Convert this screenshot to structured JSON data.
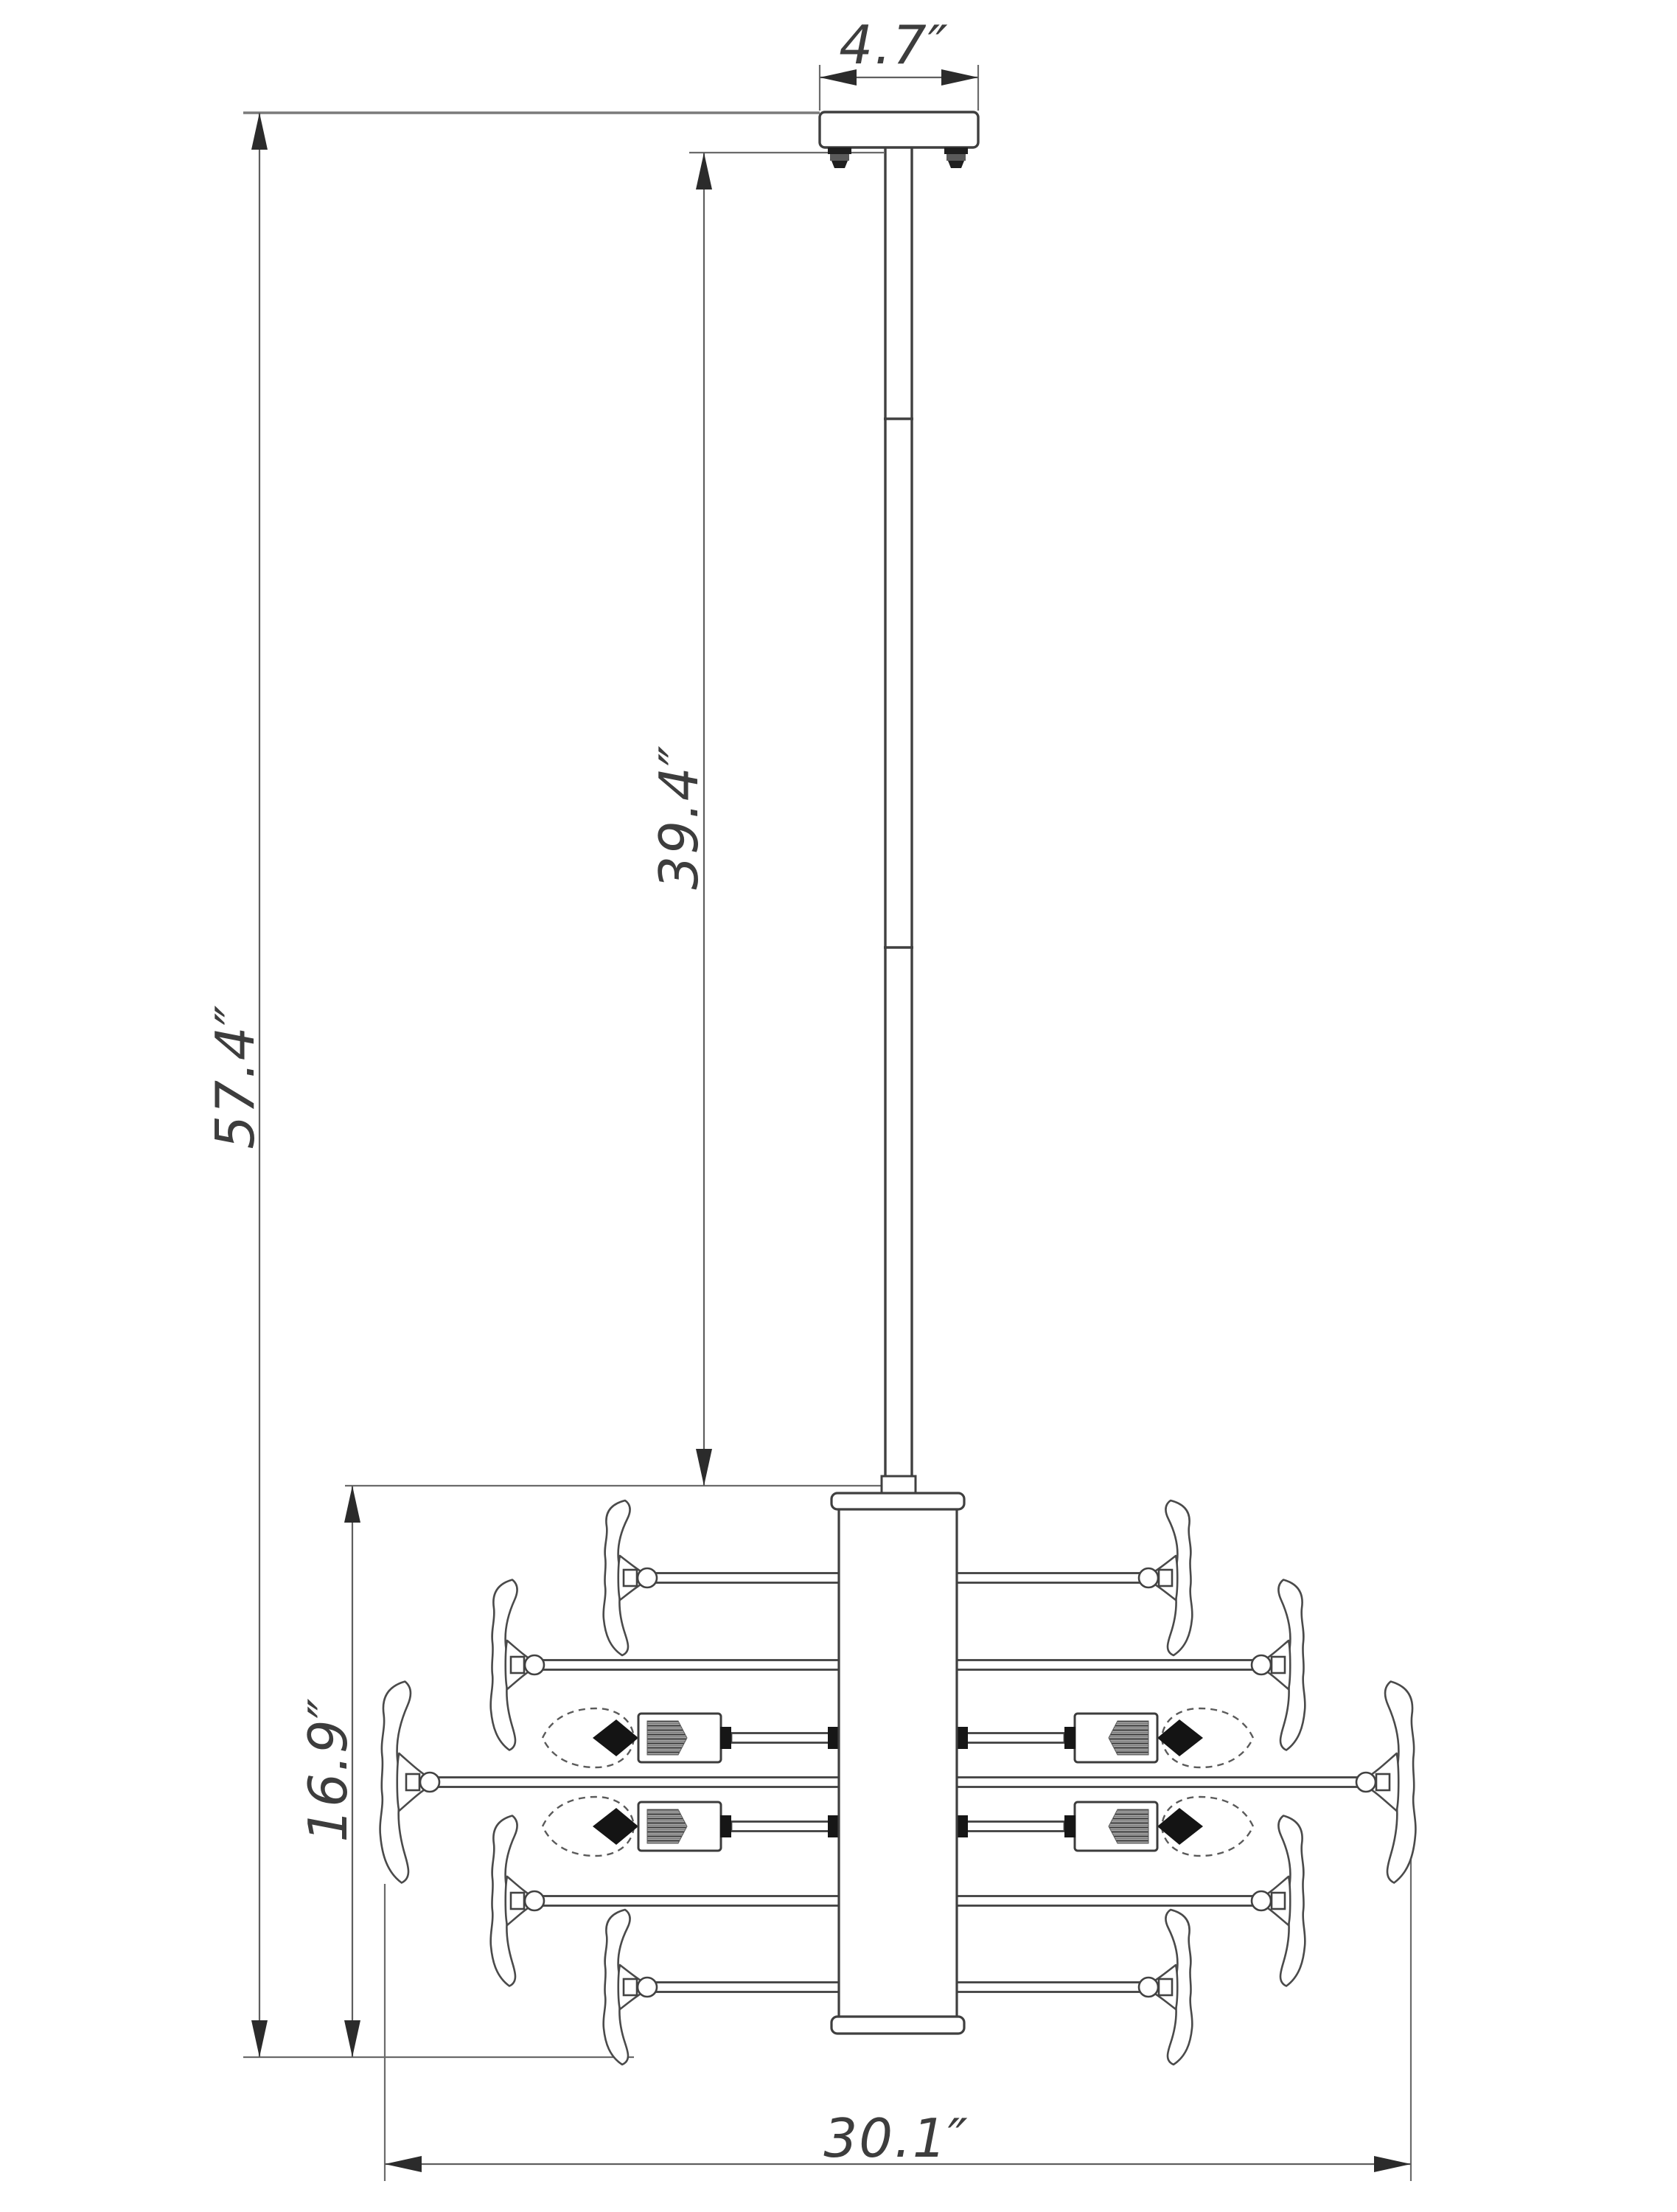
{
  "labels": {
    "canopy_width": "4.7″",
    "rod_height": "39.4″",
    "overall_height": "57.4″",
    "body_height": "16.9″",
    "body_width": "30.1″"
  },
  "colors": {
    "drawing_line": "#3f3f3f",
    "dimension_line": "#5f5f5f",
    "extension_line": "#6b6b6b",
    "text": "#3d3d3d",
    "background": "#ffffff"
  }
}
